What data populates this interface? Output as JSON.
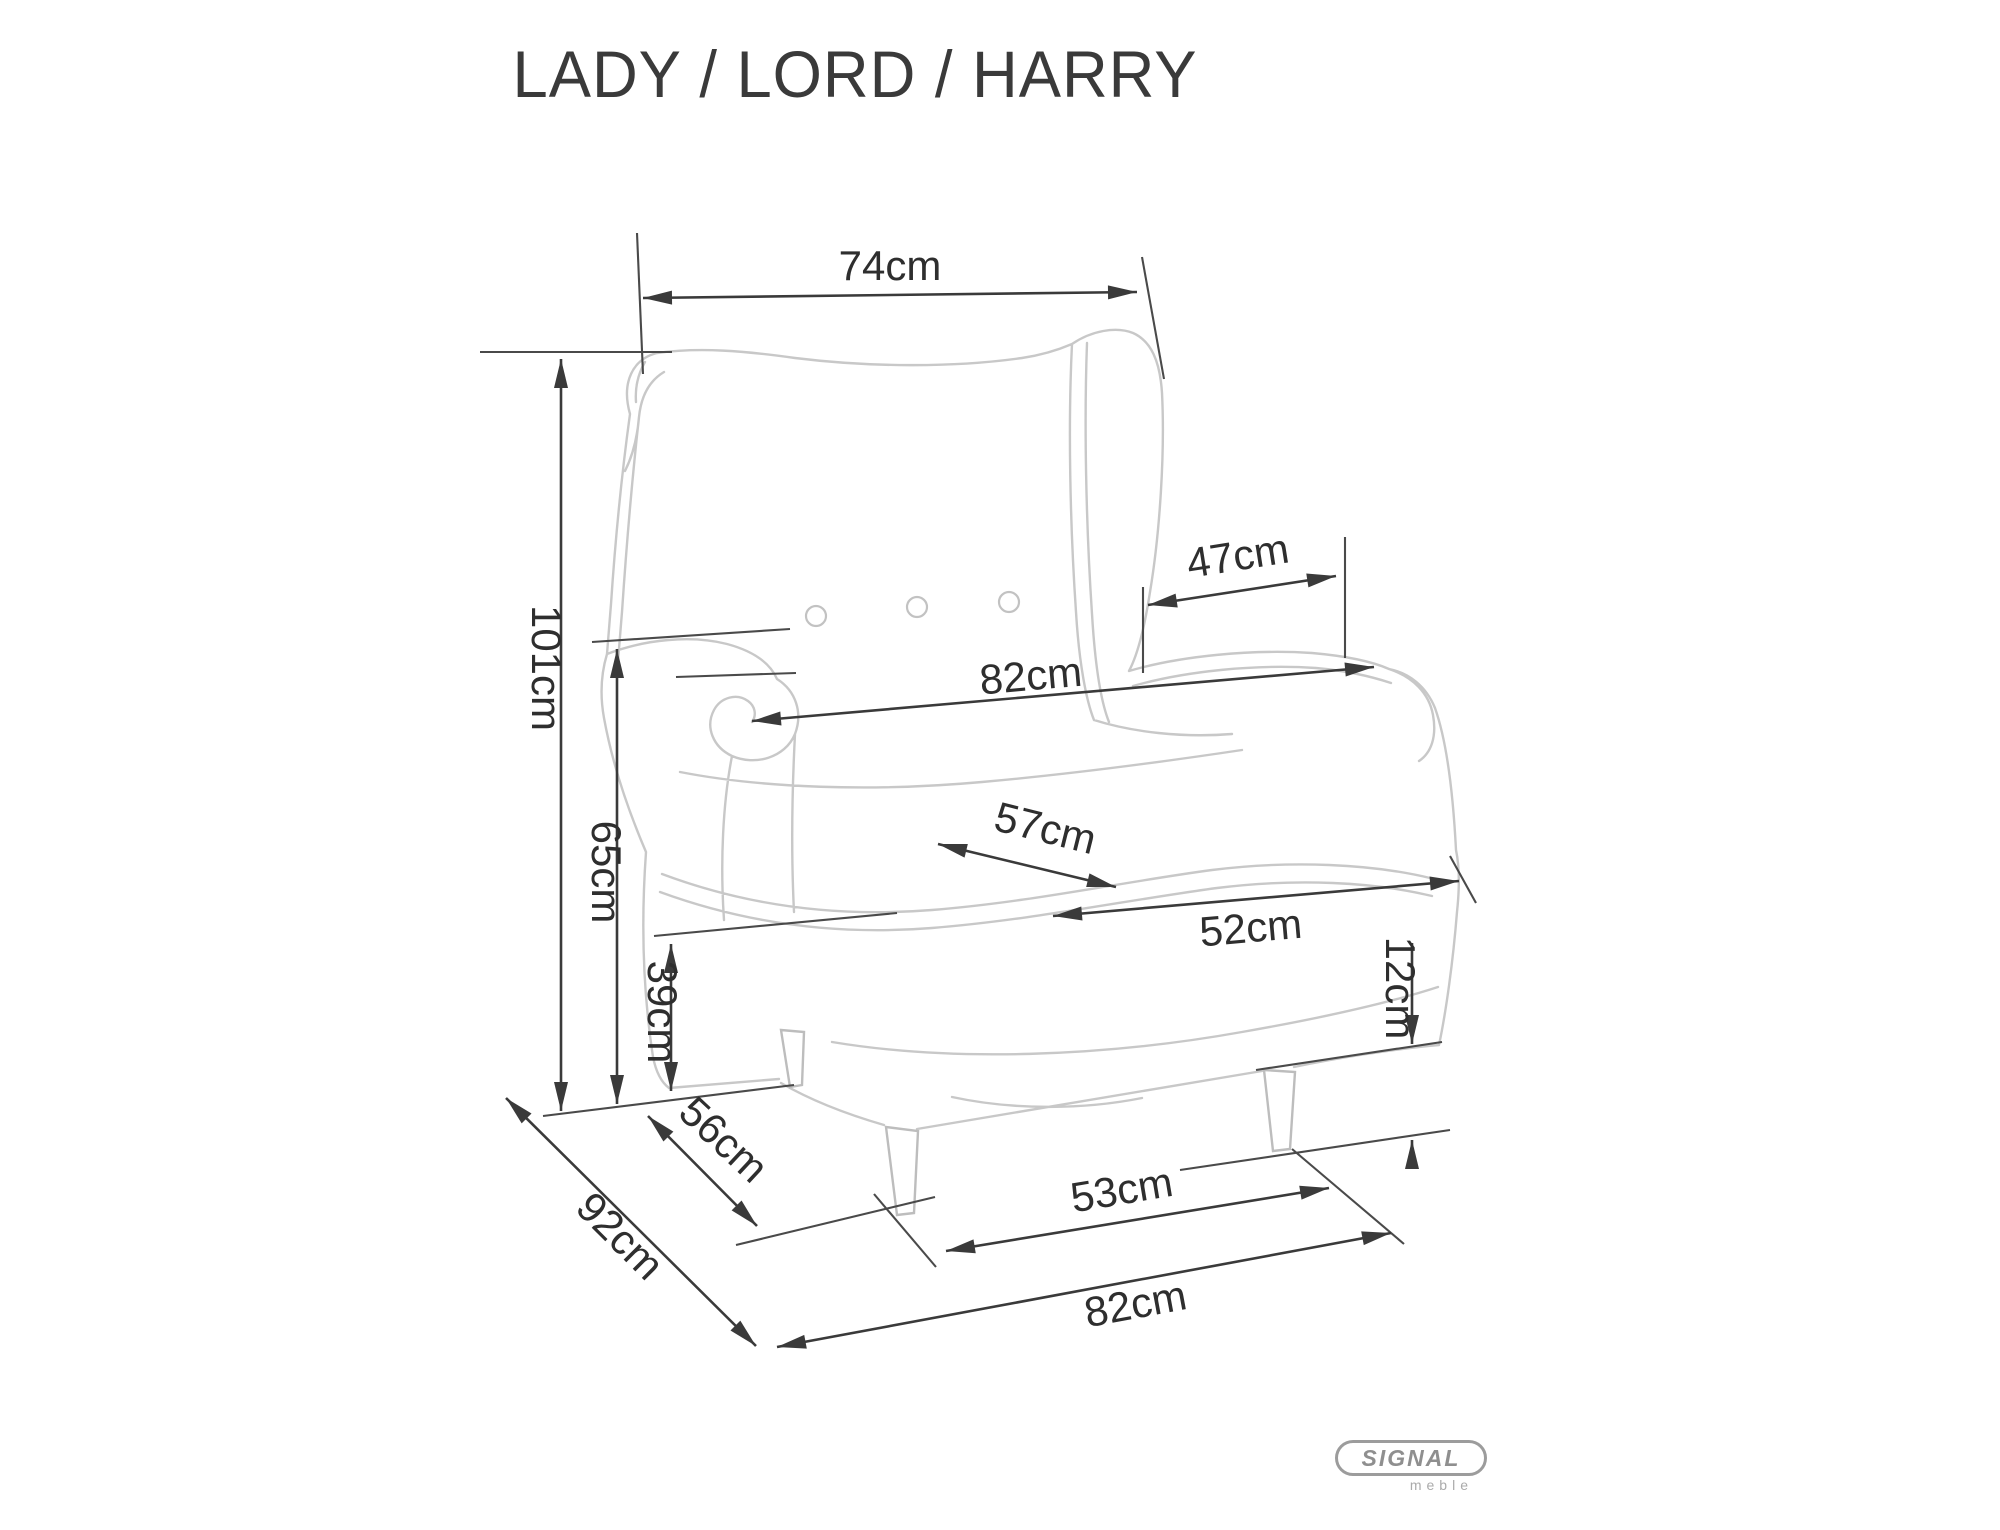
{
  "title": "LADY / LORD / HARRY",
  "dimensions": {
    "back_width": {
      "label": "74cm",
      "value": 74,
      "unit": "cm"
    },
    "total_height": {
      "label": "101cm",
      "value": 101,
      "unit": "cm"
    },
    "armrest_height": {
      "label": "65cm",
      "value": 65,
      "unit": "cm"
    },
    "seat_height": {
      "label": "39cm",
      "value": 39,
      "unit": "cm"
    },
    "armrest_inner": {
      "label": "47cm",
      "value": 47,
      "unit": "cm"
    },
    "overall_width": {
      "label": "82cm",
      "value": 82,
      "unit": "cm"
    },
    "seat_width": {
      "label": "57cm",
      "value": 57,
      "unit": "cm"
    },
    "seat_depth": {
      "label": "52cm",
      "value": 52,
      "unit": "cm"
    },
    "leg_height": {
      "label": "12cm",
      "value": 12,
      "unit": "cm"
    },
    "base_depth": {
      "label": "56cm",
      "value": 56,
      "unit": "cm"
    },
    "overall_depth": {
      "label": "92cm",
      "value": 92,
      "unit": "cm"
    },
    "front_leg_span": {
      "label": "53cm",
      "value": 53,
      "unit": "cm"
    },
    "base_width": {
      "label": "82cm",
      "value": 82,
      "unit": "cm"
    }
  },
  "logo": {
    "brand": "SIGNAL",
    "sub": "meble"
  },
  "colors": {
    "dimension_line": "#3a3a3a",
    "reference_line": "#4a4a4a",
    "sketch_line": "#c8c8c8",
    "label_text": "#2e2e2e",
    "logo_gray": "#9c9c9c",
    "background": "#ffffff"
  }
}
